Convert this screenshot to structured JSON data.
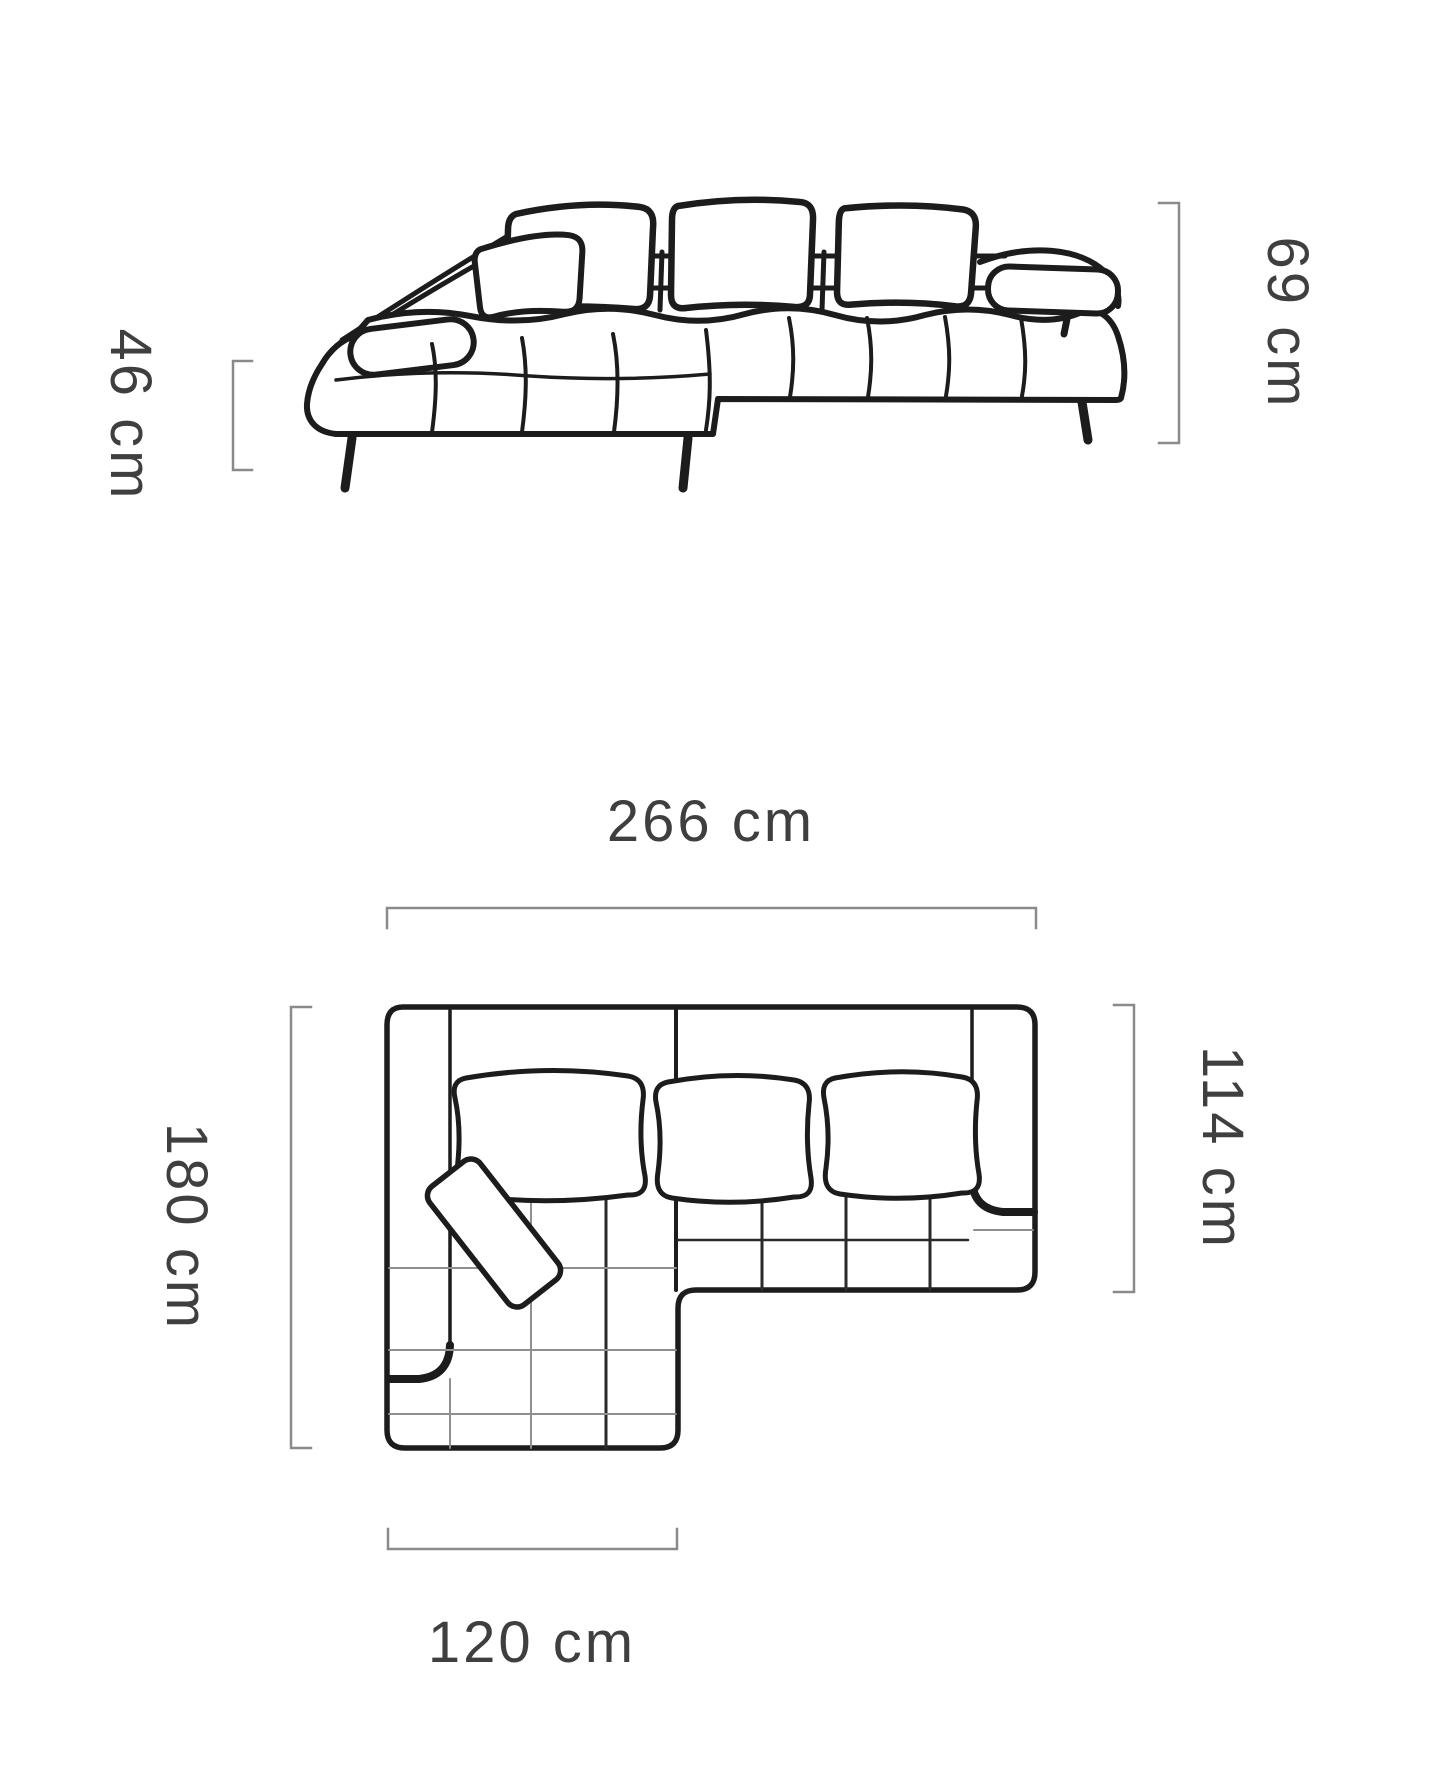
{
  "colors": {
    "line": "#1c1c1c",
    "bracket": "#8a8a8a",
    "label": "#3f3f3f",
    "background": "#ffffff"
  },
  "diagram": {
    "type": "furniture-dimension-diagram",
    "subject": "corner-sofa",
    "unit": "cm",
    "dimensions": {
      "front_view": {
        "seat_height": {
          "value": "46 cm",
          "orientation": "vertical"
        },
        "back_height": {
          "value": "69 cm",
          "orientation": "vertical"
        }
      },
      "top_view": {
        "total_width": {
          "value": "266 cm",
          "orientation": "horizontal"
        },
        "total_depth": {
          "value": "180 cm",
          "orientation": "vertical"
        },
        "side_depth": {
          "value": "114 cm",
          "orientation": "vertical"
        },
        "chaise_width": {
          "value": "120 cm",
          "orientation": "horizontal"
        }
      }
    }
  }
}
